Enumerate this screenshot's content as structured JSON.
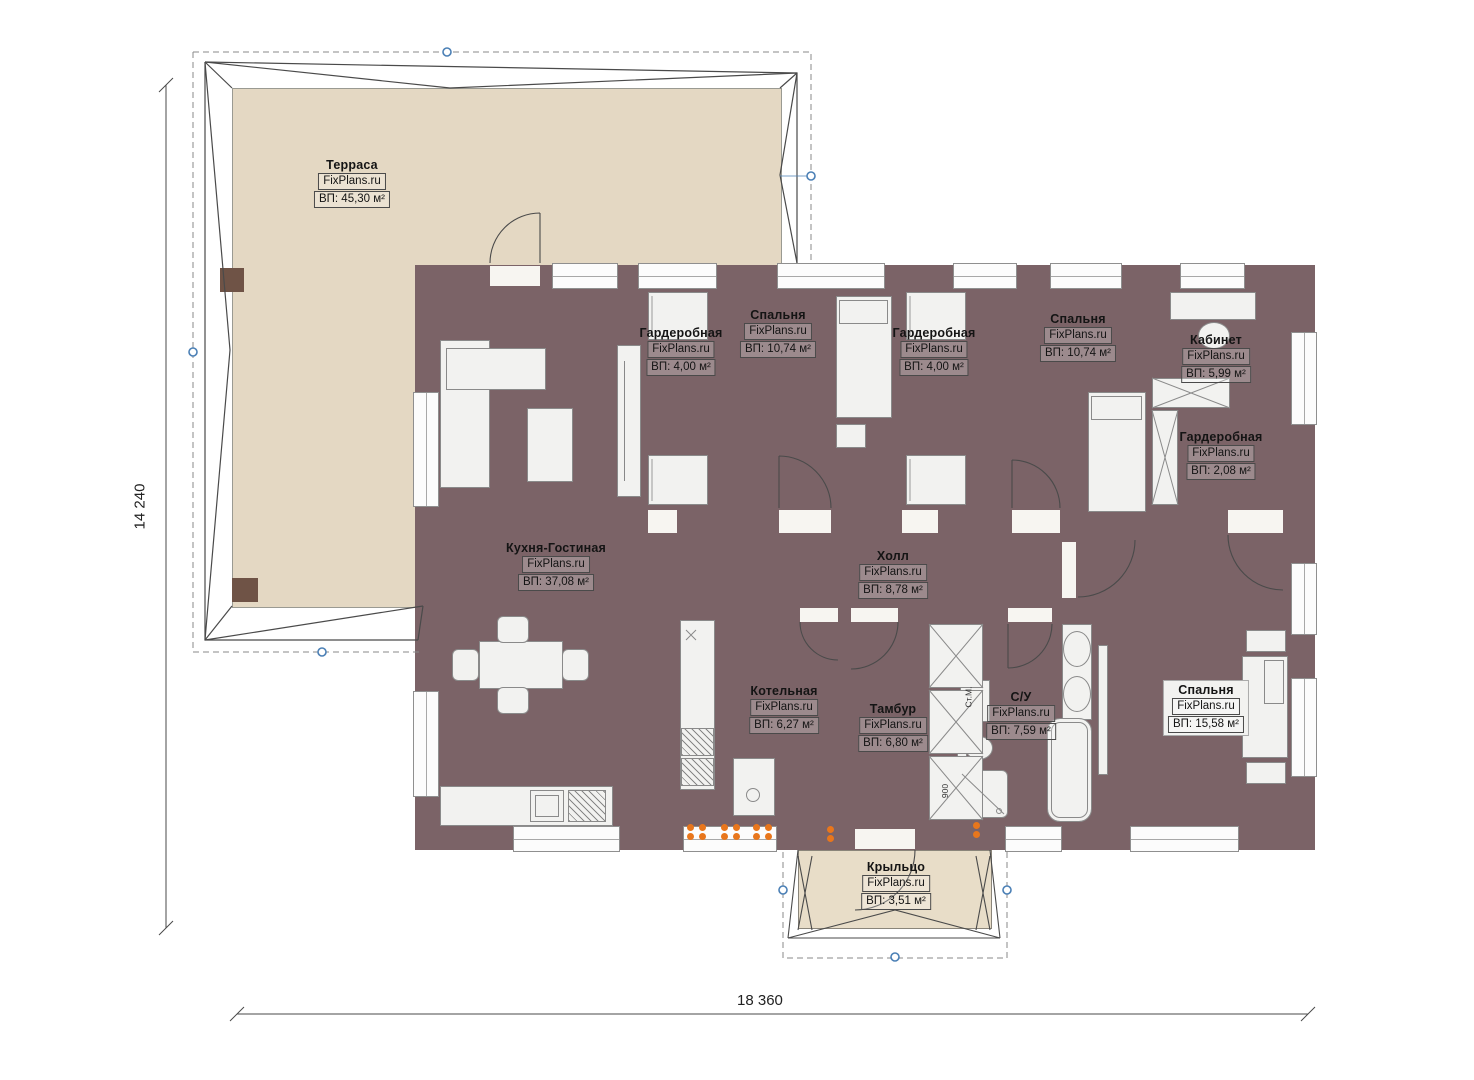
{
  "watermark": "FixPlans.ru",
  "dimensions": {
    "height": "14 240",
    "width": "18 360"
  },
  "rooms": [
    {
      "id": "terrace",
      "name": "Терраса",
      "area": "ВП: 45,30 м²"
    },
    {
      "id": "wardrobe1",
      "name": "Гардеробная",
      "area": "ВП: 4,00 м²"
    },
    {
      "id": "bedroom1",
      "name": "Спальня",
      "area": "ВП: 10,74 м²"
    },
    {
      "id": "wardrobe2",
      "name": "Гардеробная",
      "area": "ВП: 4,00 м²"
    },
    {
      "id": "bedroom2",
      "name": "Спальня",
      "area": "ВП: 10,74 м²"
    },
    {
      "id": "cabinet",
      "name": "Кабинет",
      "area": "ВП: 5,99 м²"
    },
    {
      "id": "wardrobe3",
      "name": "Гардеробная",
      "area": "ВП: 2,08 м²"
    },
    {
      "id": "kitchen",
      "name": "Кухня-Гостиная",
      "area": "ВП: 37,08 м²"
    },
    {
      "id": "hall",
      "name": "Холл",
      "area": "ВП: 8,78 м²"
    },
    {
      "id": "boiler",
      "name": "Котельная",
      "area": "ВП: 6,27 м²"
    },
    {
      "id": "vestibule",
      "name": "Тамбур",
      "area": "ВП: 6,80 м²"
    },
    {
      "id": "bathroom",
      "name": "С/У",
      "area": "ВП: 7,59 м²"
    },
    {
      "id": "bedroom3",
      "name": "Спальня",
      "area": "ВП: 15,58 м²"
    },
    {
      "id": "porch",
      "name": "Крыльцо",
      "area": "ВП: 3,51 м²"
    }
  ],
  "annotations": {
    "washing_machine": "Ст.М.",
    "shower_size": "900"
  },
  "colors": {
    "wall": "#7b6367",
    "tile_tan": "#d7bf91",
    "floor_dark": "#8c7454",
    "tile_blue": "#b3d7f2",
    "tile_gray": "#e4e4e4",
    "terrace": "#e4d8c3",
    "radiator": "#e8761c",
    "marker_blue": "#4a7fb5"
  }
}
